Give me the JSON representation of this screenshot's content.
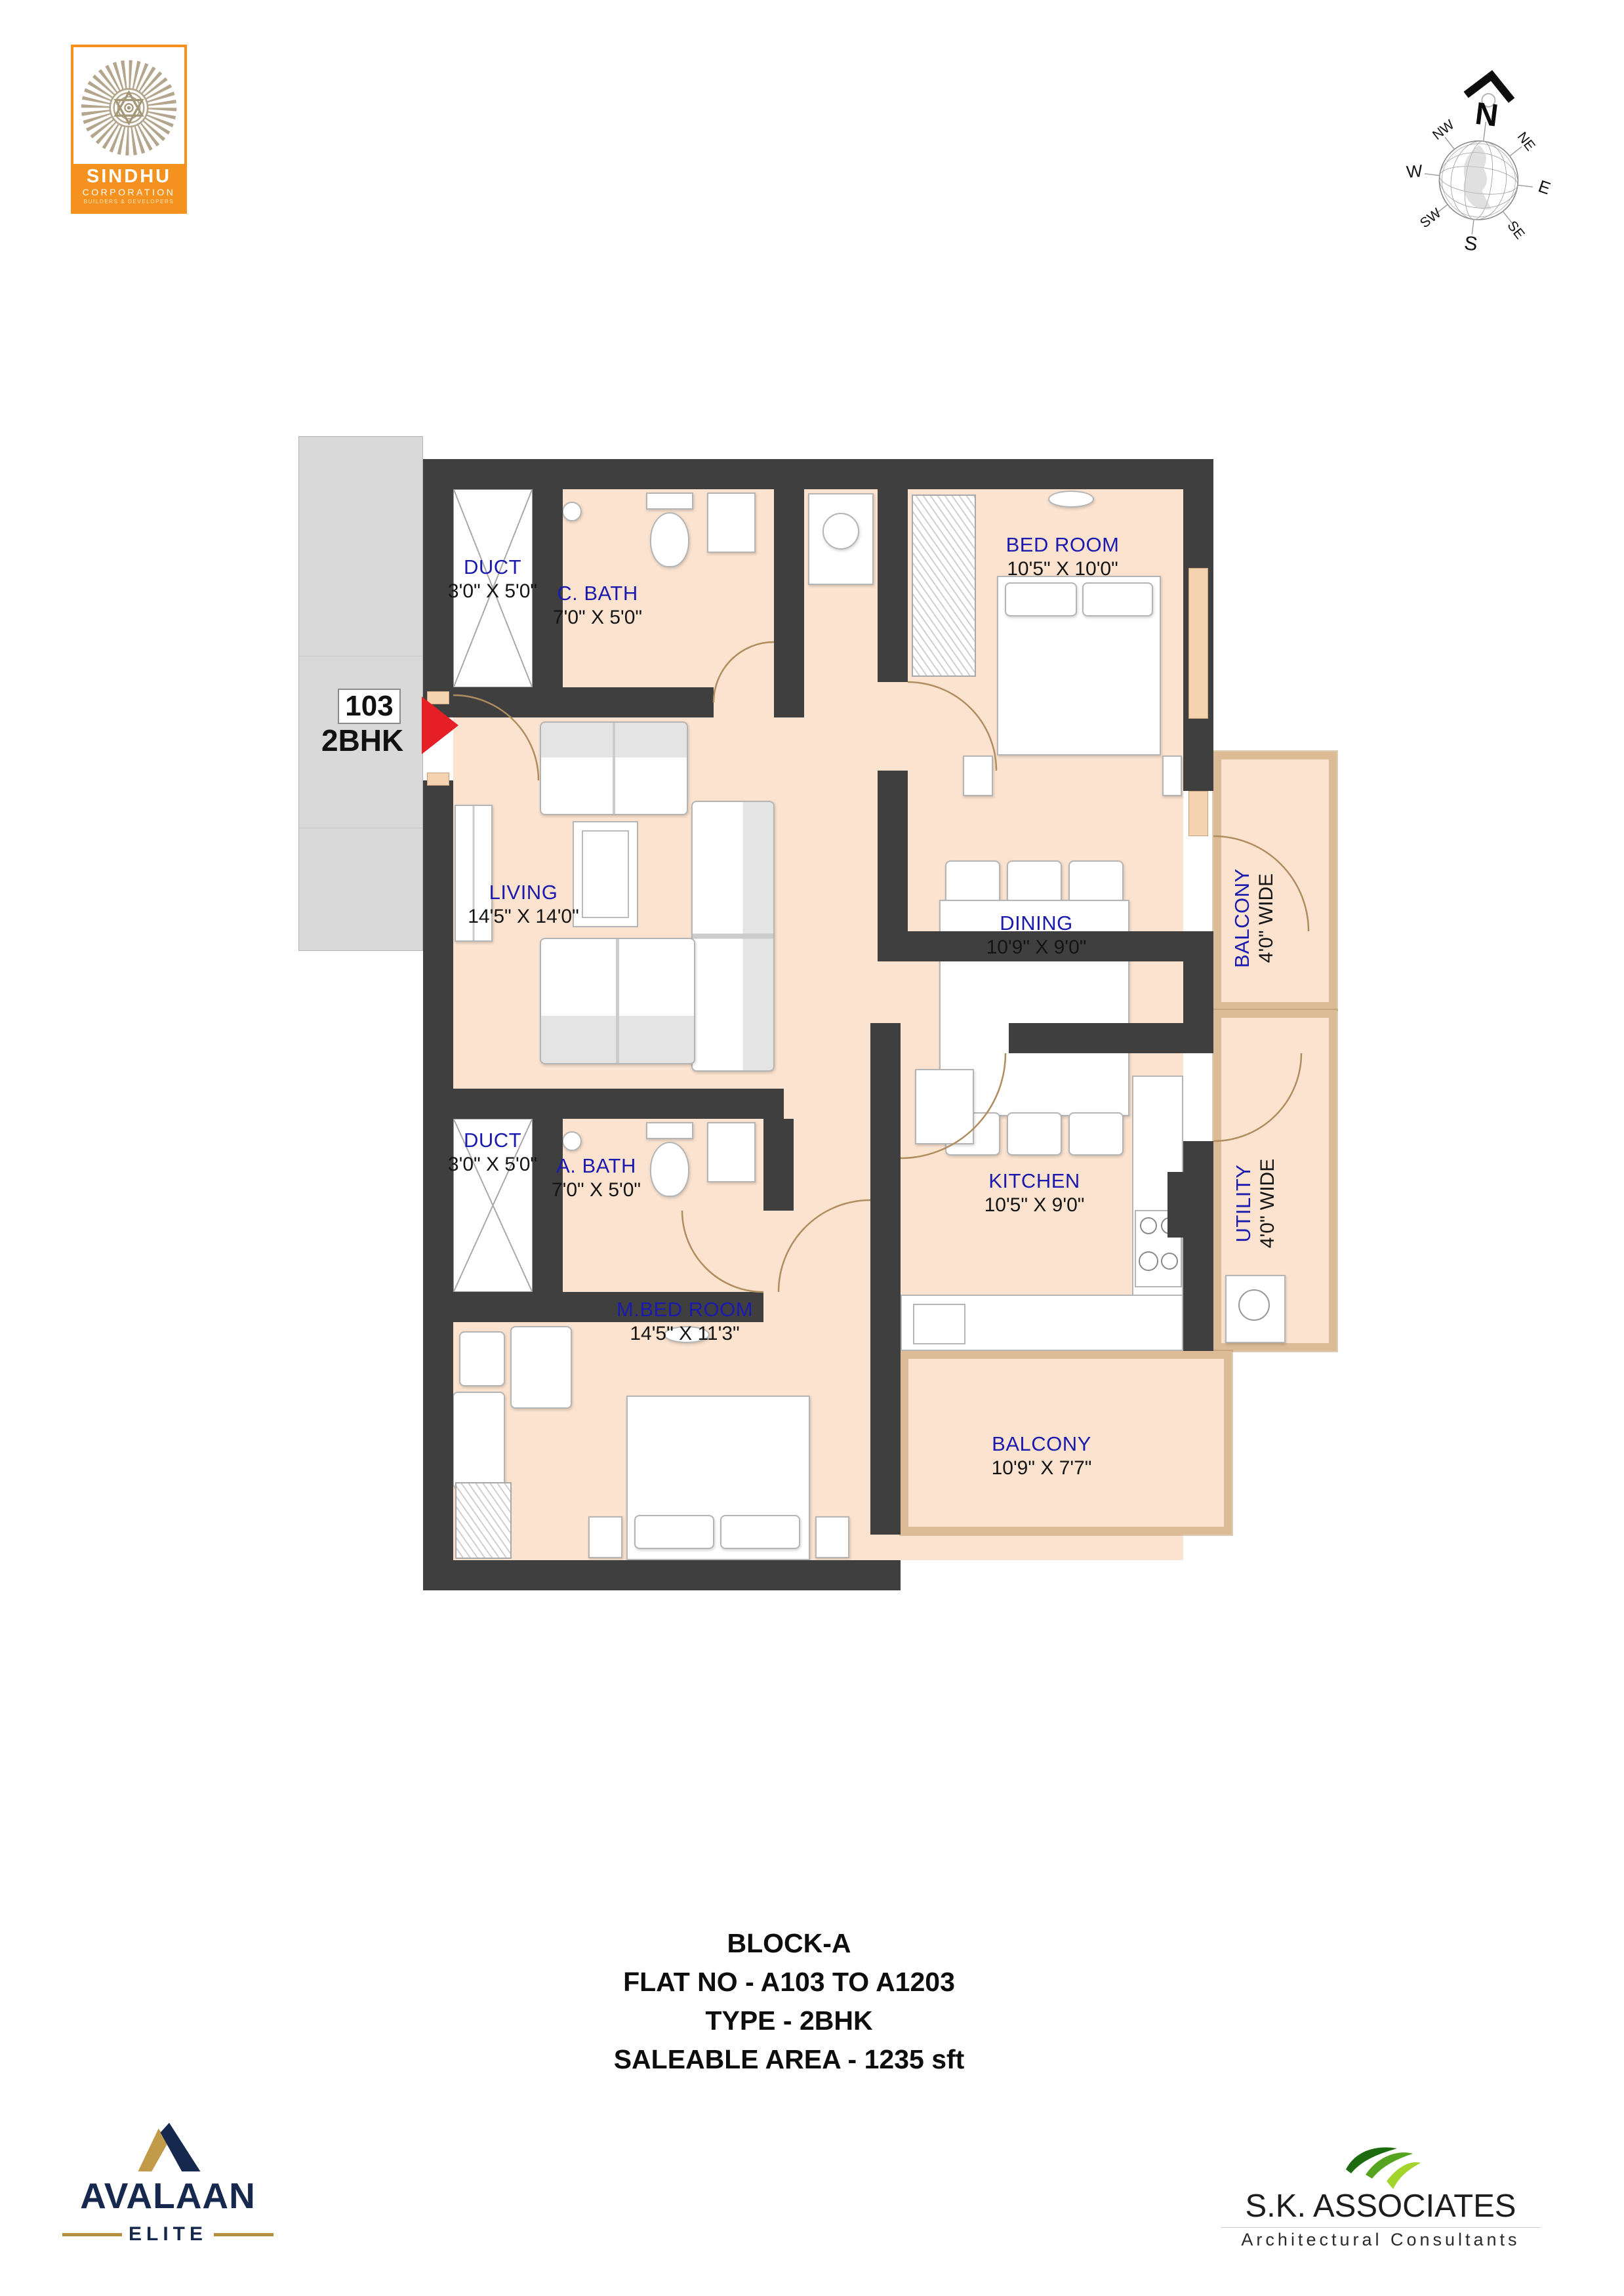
{
  "branding": {
    "sindhu": {
      "line1": "SINDHU",
      "line2": "CORPORATION",
      "line3": "BUILDERS & DEVELOPERS"
    },
    "avalaan": {
      "name": "AVALAAN",
      "tier": "ELITE"
    },
    "sk_associates": {
      "name": "S.K. ASSOCIATES",
      "subtitle": "Architectural Consultants"
    }
  },
  "compass": {
    "north": "N",
    "north_west": "NW",
    "north_east": "NE",
    "west": "W",
    "east": "E",
    "south_west": "SW",
    "south_east": "SE",
    "south": "S"
  },
  "flat_marker": {
    "number": "103",
    "type": "2BHK"
  },
  "rooms": {
    "duct_top": {
      "name": "DUCT",
      "dims": "3'0\" X 5'0\""
    },
    "c_bath": {
      "name": "C. BATH",
      "dims": "7'0\" X 5'0\""
    },
    "bed_room": {
      "name": "BED ROOM",
      "dims": "10'5\" X 10'0\""
    },
    "living": {
      "name": "LIVING",
      "dims": "14'5\" X 14'0\""
    },
    "dining": {
      "name": "DINING",
      "dims": "10'9\" X 9'0\""
    },
    "balcony_right": {
      "name": "BALCONY",
      "dims": "4'0\" WIDE"
    },
    "duct_bottom": {
      "name": "DUCT",
      "dims": "3'0\" X 5'0\""
    },
    "a_bath": {
      "name": "A. BATH",
      "dims": "7'0\" X 5'0\""
    },
    "kitchen": {
      "name": "KITCHEN",
      "dims": "10'5\" X 9'0\""
    },
    "utility": {
      "name": "UTILITY",
      "dims": "4'0\" WIDE"
    },
    "m_bed_room": {
      "name": "M.BED ROOM",
      "dims": "14'5\" X 11'3\""
    },
    "balcony_bottom": {
      "name": "BALCONY",
      "dims": "10'9\" X 7'7\""
    }
  },
  "details": {
    "block": "BLOCK-A",
    "flat_no": "FLAT NO - A103 TO A1203",
    "type": "TYPE - 2BHK",
    "saleable_area": "SALEABLE AREA - 1235 sft"
  },
  "colors": {
    "wall": "#3f3f3f",
    "floor": "#fbe3d0",
    "label_blue": "#1a1aae",
    "corridor_gray": "#d9d9d9",
    "balcony_wall": "#dcbb97",
    "arrow_red": "#e61e25",
    "brand_orange": "#f5911e",
    "brand_navy": "#16284d",
    "brand_gold": "#b2903f",
    "leaf_green": "#4ea321"
  }
}
